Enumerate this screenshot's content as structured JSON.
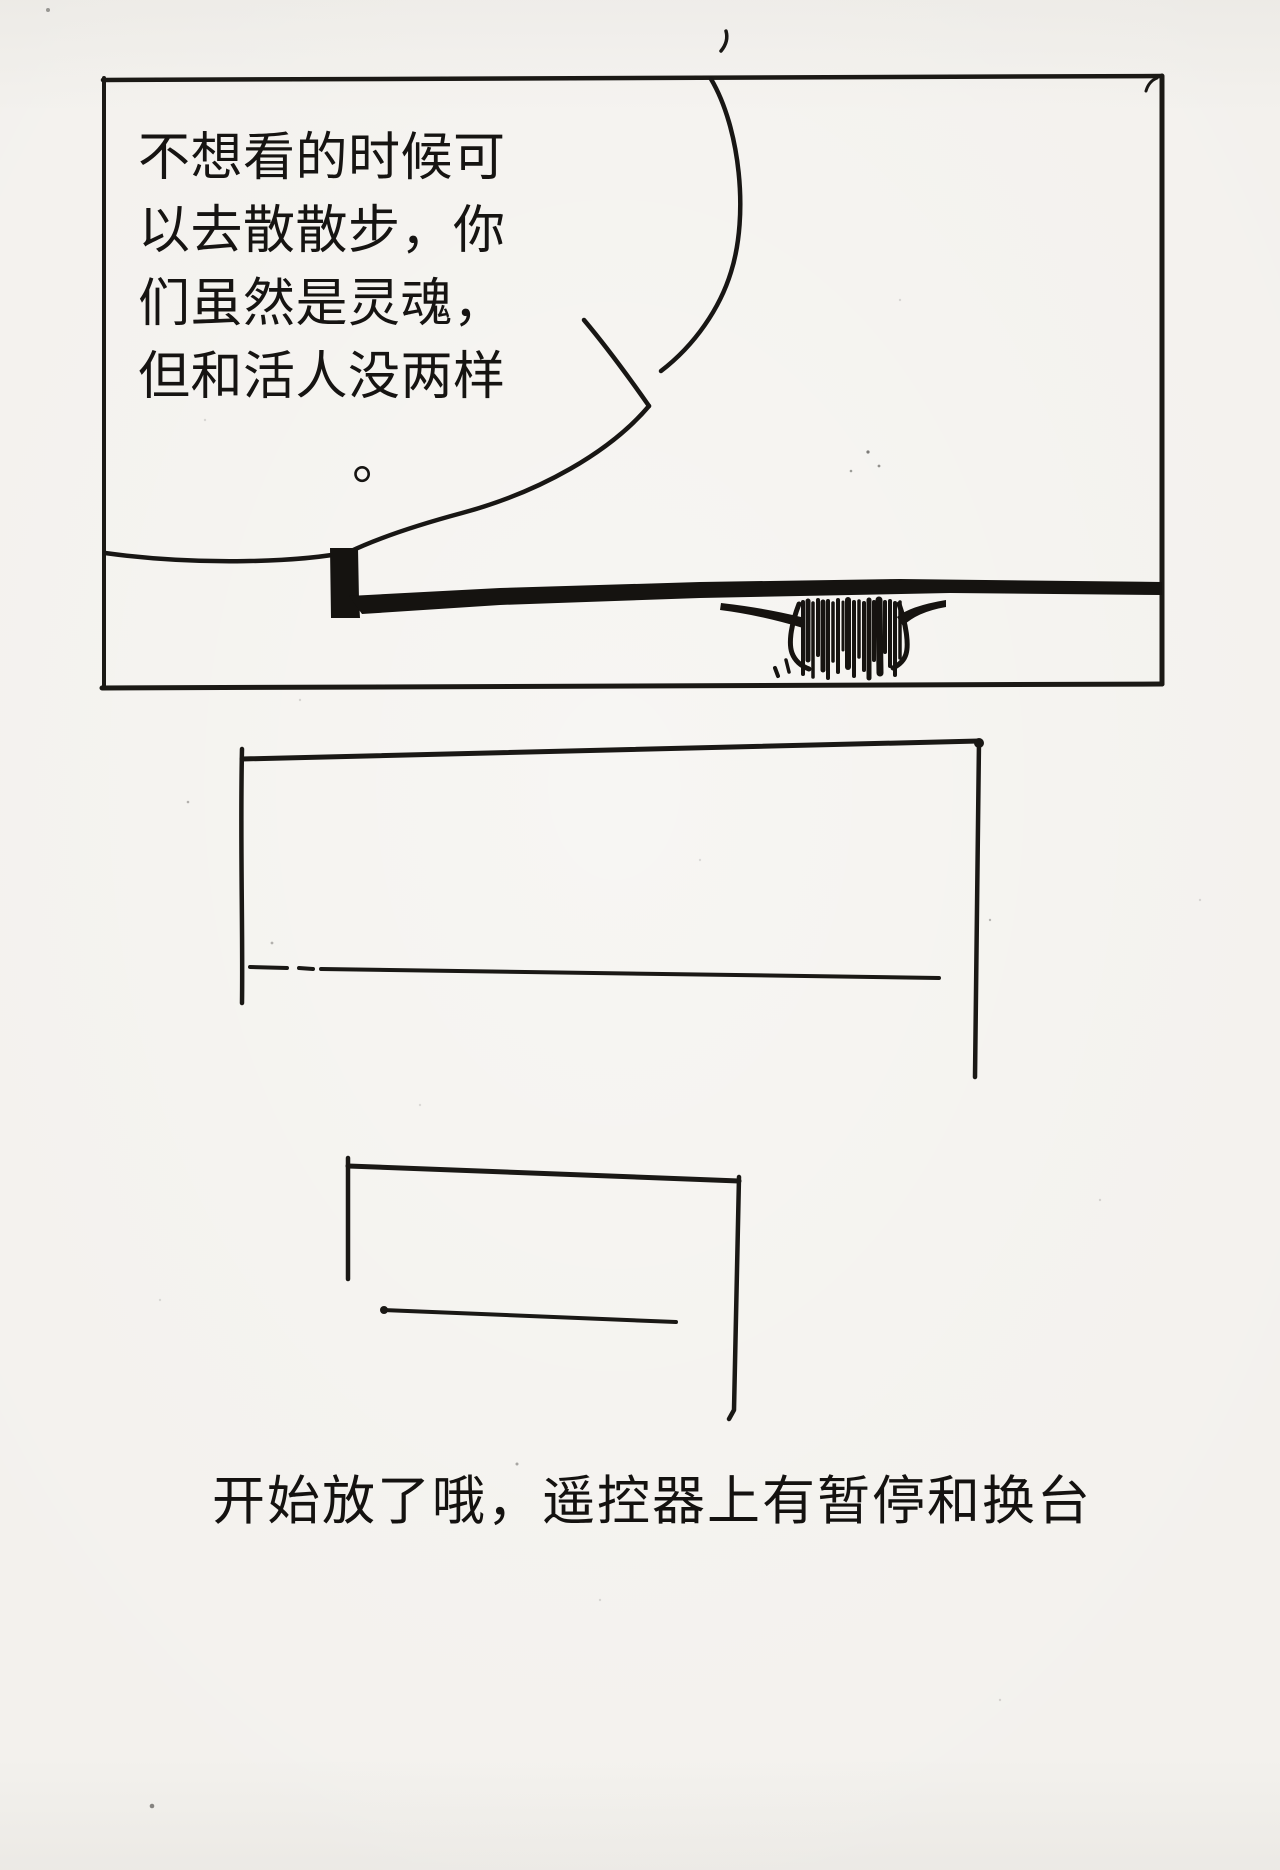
{
  "page": {
    "kind": "hand-drawn comic page",
    "paper_color": "#f3f1ed",
    "ink_color": "#171512"
  },
  "panel1": {
    "speech_bubble": {
      "text": "不想看的时候可\n以去散散步，你\n们虽然是灵魂，\n但和活人没两样",
      "period": "。"
    }
  },
  "caption": {
    "text": "开始放了哦，遥控器上有暂停和换台"
  }
}
